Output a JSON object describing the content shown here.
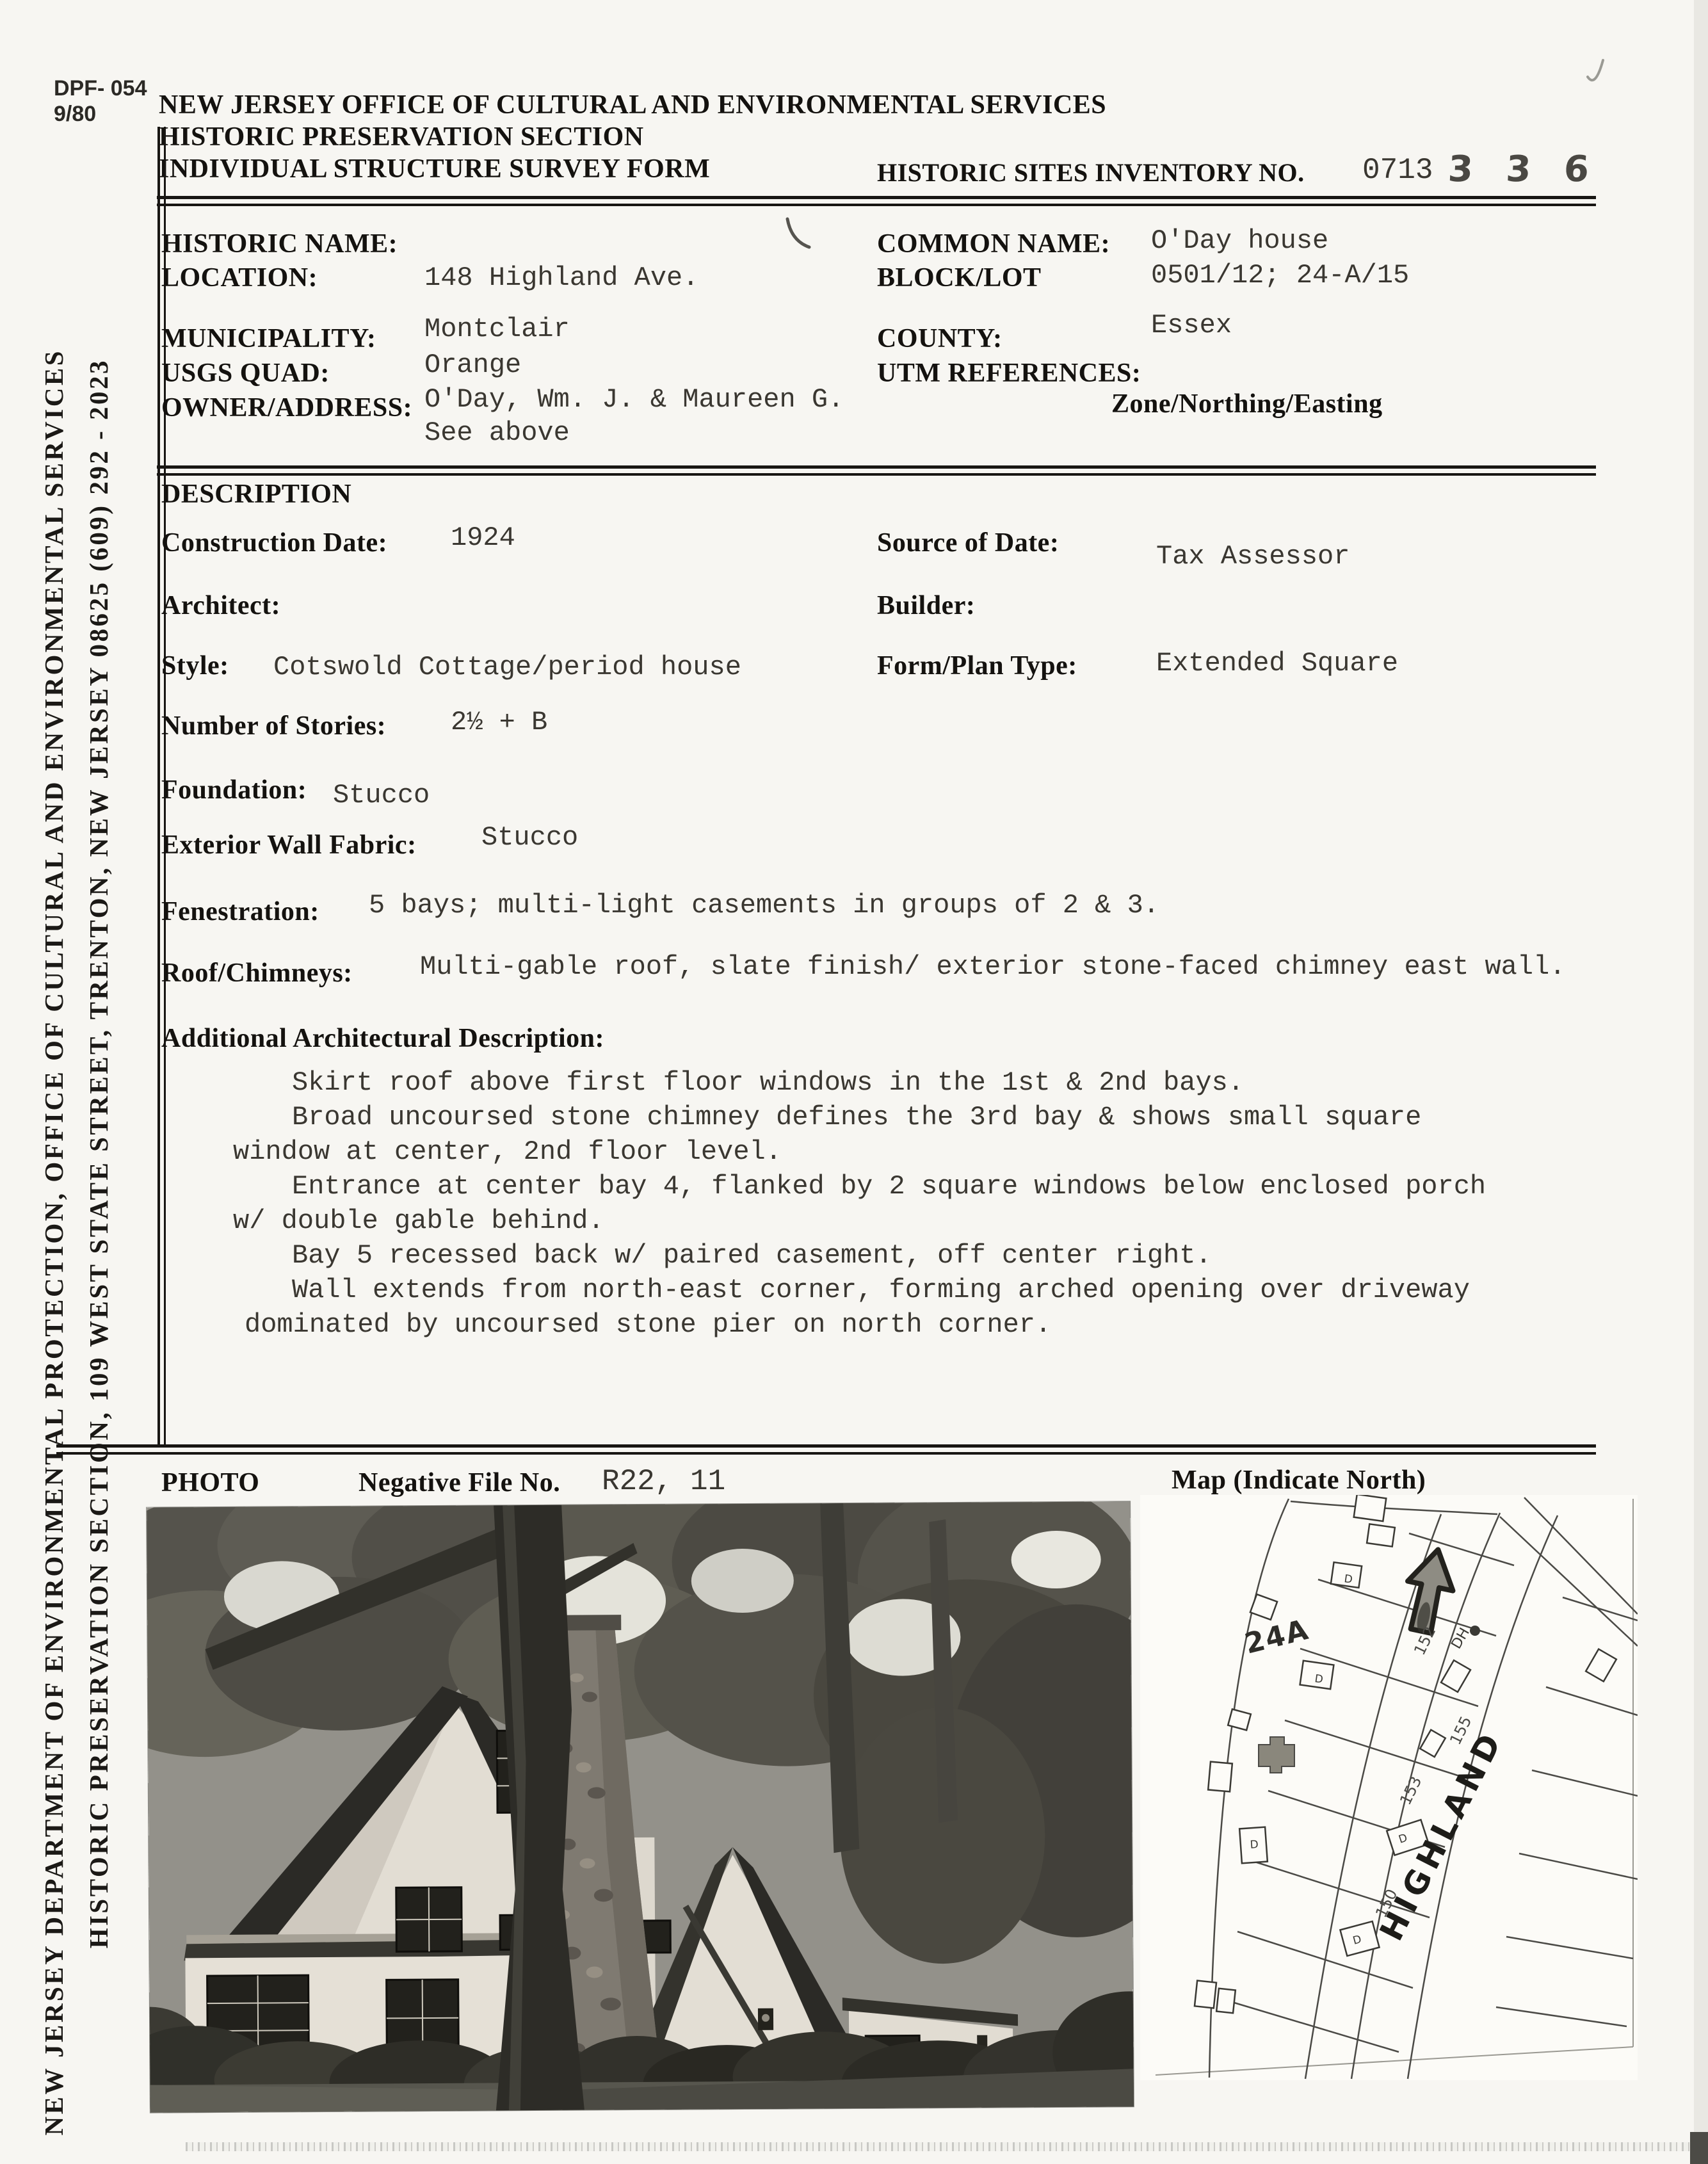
{
  "form_code": {
    "line1": "DPF- 054",
    "line2": "9/80"
  },
  "header": {
    "agency_line1": "NEW JERSEY OFFICE OF CULTURAL AND ENVIRONMENTAL SERVICES",
    "agency_line2": "HISTORIC PRESERVATION SECTION",
    "agency_line3": "INDIVIDUAL STRUCTURE SURVEY FORM",
    "inventory_label": "HISTORIC SITES INVENTORY NO.",
    "inventory_typed": "0713",
    "inventory_handwritten": "3 3 6"
  },
  "sidebar": {
    "line1": "NEW JERSEY DEPARTMENT OF ENVIRONMENTAL PROTECTION, OFFICE OF CULTURAL AND ENVIRONMENTAL SERVICES",
    "line2": "HISTORIC PRESERVATION SECTION, 109 WEST STATE STREET, TRENTON, NEW JERSEY 08625   (609) 292 - 2023"
  },
  "identification": {
    "historic_name_label": "HISTORIC NAME:",
    "location_label": "LOCATION:",
    "location_value": "148 Highland Ave.",
    "municipality_label": "MUNICIPALITY:",
    "municipality_value": "Montclair",
    "usgs_quad_label": "USGS QUAD:",
    "usgs_quad_value": "Orange",
    "owner_label": "OWNER/ADDRESS:",
    "owner_value": "O'Day, Wm. J. & Maureen G.",
    "owner_value2": "See above",
    "common_name_label": "COMMON NAME:",
    "common_name_value": "O'Day house",
    "block_lot_label": "BLOCK/LOT",
    "block_lot_value": "0501/12;  24-A/15",
    "county_label": "COUNTY:",
    "county_value": "Essex",
    "utm_label": "UTM REFERENCES:",
    "utm_sublabel": "Zone/Northing/Easting"
  },
  "description": {
    "section_title": "DESCRIPTION",
    "construction_date_label": "Construction Date:",
    "construction_date_value": "1924",
    "source_of_date_label": "Source of Date:",
    "source_of_date_value": "Tax Assessor",
    "architect_label": "Architect:",
    "builder_label": "Builder:",
    "style_label": "Style:",
    "style_value": "Cotswold Cottage/period house",
    "form_plan_label": "Form/Plan Type:",
    "form_plan_value": "Extended Square",
    "stories_label": "Number of Stories:",
    "stories_value": "2½ + B",
    "foundation_label": "Foundation:",
    "foundation_value": "Stucco",
    "wall_fabric_label": "Exterior Wall Fabric:",
    "wall_fabric_value": "Stucco",
    "fenestration_label": "Fenestration:",
    "fenestration_value": "5 bays; multi-light casements in groups of 2 & 3.",
    "roof_label": "Roof/Chimneys:",
    "roof_value": "Multi-gable roof, slate finish/ exterior stone-faced chimney east wall.",
    "additional_label": "Additional Architectural Description:",
    "additional_lines": [
      "Skirt roof above first floor windows in the 1st & 2nd bays.",
      "Broad uncoursed stone chimney defines the 3rd bay & shows small square",
      "window at center, 2nd floor level.",
      "Entrance at center bay 4, flanked by 2 square windows below enclosed porch",
      "w/ double gable behind.",
      "Bay 5 recessed back w/ paired casement, off center right.",
      "Wall extends from north-east corner, forming arched opening over driveway",
      "dominated by uncoursed stone pier on north corner."
    ]
  },
  "photo_section": {
    "photo_label": "PHOTO",
    "negative_label": "Negative File No.",
    "negative_value": "R22, 11",
    "map_label": "Map  (Indicate North)"
  },
  "map": {
    "parcel_label": "24A",
    "street_label": "HIGHLAND",
    "dh_label": "DH",
    "footprint_mark": "D",
    "lot_numbers": [
      "150",
      "152",
      "153",
      "155"
    ]
  }
}
